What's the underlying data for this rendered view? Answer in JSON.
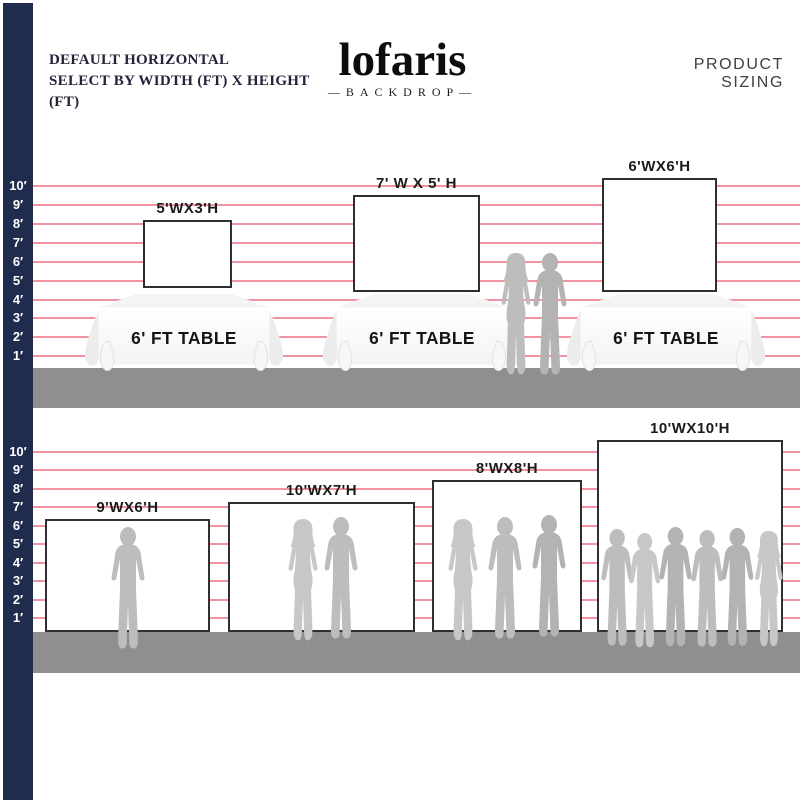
{
  "header": {
    "title_line1": "DEFAULT HORIZONTAL",
    "title_line2": "SELECT BY WIDTH (FT) X HEIGHT (FT)",
    "brand": "lofaris",
    "brand_tagline": "—BACKDROP—",
    "right_title": "PRODUCT SIZING"
  },
  "ruler_labels": [
    "10′",
    "9′",
    "8′",
    "7′",
    "6′",
    "5′",
    "4′",
    "3′",
    "2′",
    "1′"
  ],
  "top_section": {
    "backdrops": [
      {
        "label": "5'WX3'H",
        "width_ft": 5,
        "height_ft": 3
      },
      {
        "label": "7' W X 5' H",
        "width_ft": 7,
        "height_ft": 5
      },
      {
        "label": "6'WX6'H",
        "width_ft": 6,
        "height_ft": 6
      }
    ],
    "tables": [
      {
        "label": "6' FT TABLE"
      },
      {
        "label": "6' FT TABLE"
      },
      {
        "label": "6' FT TABLE"
      }
    ]
  },
  "bottom_section": {
    "backdrops": [
      {
        "label": "9'WX6'H",
        "width_ft": 9,
        "height_ft": 6
      },
      {
        "label": "10'WX7'H",
        "width_ft": 10,
        "height_ft": 7
      },
      {
        "label": "8'WX8'H",
        "width_ft": 8,
        "height_ft": 8
      },
      {
        "label": "10'WX10'H",
        "width_ft": 10,
        "height_ft": 10
      }
    ]
  },
  "colors": {
    "navy": "#202c4e",
    "line_pink": "#ee8090",
    "floor_gray": "#8f8f8f",
    "silhouette_gray": "#bdbdbd",
    "border_dark": "#2f2f2f"
  }
}
